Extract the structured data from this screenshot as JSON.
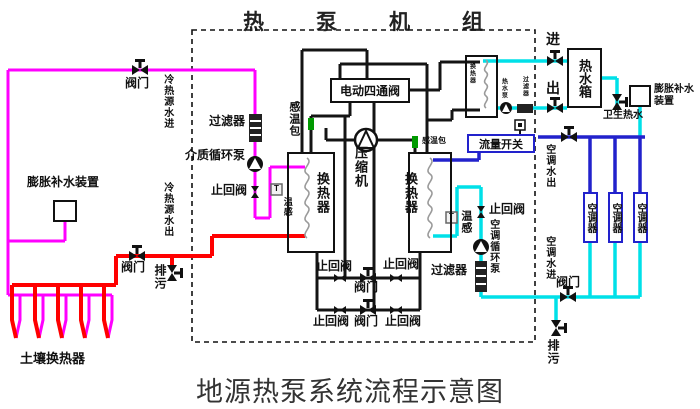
{
  "titles": {
    "top": "热泵机组",
    "bottom": "地源热泵系统流程示意图"
  },
  "colors": {
    "magenta": "#ff00ff",
    "red": "#ff0000",
    "cyan": "#00e0e8",
    "blue": "#2222cc",
    "green": "#009900",
    "pipe_black": "#141414"
  },
  "boxes": {
    "four_way_valve": "电动四通阀",
    "flow_switch": "流量开关",
    "tank": "热水箱",
    "ac_units": [
      "空调器",
      "空调器",
      "空调器"
    ]
  },
  "labels": [
    {
      "name": "valve-label-topleft",
      "text": "阀门",
      "x": 125,
      "y": 77,
      "s": 12
    },
    {
      "name": "source-water-in-label",
      "text": "冷热源水进",
      "x": 161,
      "y": 74,
      "s": 10,
      "v": true
    },
    {
      "name": "source-water-out-label",
      "text": "冷热源水出",
      "x": 161,
      "y": 182,
      "s": 10,
      "v": true
    },
    {
      "name": "filter-label-left",
      "text": "过滤器",
      "x": 209,
      "y": 115,
      "s": 12
    },
    {
      "name": "medium-pump-label",
      "text": "介质循环泵",
      "x": 185,
      "y": 149,
      "s": 12
    },
    {
      "name": "check-valve-label-left",
      "text": "止回阀",
      "x": 211,
      "y": 184,
      "s": 12
    },
    {
      "name": "temp-sensor-glyph-left",
      "text": "T",
      "x": 274,
      "y": 185,
      "s": 8
    },
    {
      "name": "temp-sensor-label-left",
      "text": "温感",
      "x": 282,
      "y": 197,
      "s": 9,
      "v": true
    },
    {
      "name": "bulb-label-left",
      "text": "感温包",
      "x": 287,
      "y": 101,
      "s": 11,
      "v": true
    },
    {
      "name": "bulb-label-right",
      "text": "感温包",
      "x": 422,
      "y": 137,
      "s": 8
    },
    {
      "name": "compressor-label",
      "text": "压缩机",
      "x": 353,
      "y": 146,
      "s": 13,
      "v": true
    },
    {
      "name": "hx-label-left",
      "text": "换热器",
      "x": 315,
      "y": 172,
      "s": 13,
      "v": true
    },
    {
      "name": "hx-label-right",
      "text": "换热器",
      "x": 403,
      "y": 172,
      "s": 13,
      "v": true
    },
    {
      "name": "hx-label-hotwater",
      "text": "换热器",
      "x": 468,
      "y": 63,
      "s": 6,
      "v": true
    },
    {
      "name": "hotwater-pump-label",
      "text": "热水泵",
      "x": 500,
      "y": 78,
      "s": 6,
      "v": true
    },
    {
      "name": "hotwater-filter-label",
      "text": "过滤器",
      "x": 521,
      "y": 76,
      "s": 6,
      "v": true
    },
    {
      "name": "inlet-label",
      "text": "进",
      "x": 546,
      "y": 32,
      "s": 14
    },
    {
      "name": "outlet-label",
      "text": "出",
      "x": 546,
      "y": 81,
      "s": 14
    },
    {
      "name": "sanitary-hotwater-label",
      "text": "卫生热水",
      "x": 603,
      "y": 111,
      "s": 10
    },
    {
      "name": "expansion-label-right",
      "text": "膨胀补水装置",
      "x": 654,
      "y": 84,
      "s": 10,
      "w": 46
    },
    {
      "name": "ac-water-out-label",
      "text": "空调水出",
      "x": 543,
      "y": 144,
      "s": 10,
      "v": true
    },
    {
      "name": "ac-water-in-label",
      "text": "空调水进",
      "x": 543,
      "y": 236,
      "s": 10,
      "v": true
    },
    {
      "name": "valve-label-ac",
      "text": "阀门",
      "x": 556,
      "y": 276,
      "s": 12
    },
    {
      "name": "drain-label-right",
      "text": "排污",
      "x": 546,
      "y": 339,
      "s": 12,
      "v": true
    },
    {
      "name": "check-valve-label-ac",
      "text": "止回阀",
      "x": 489,
      "y": 203,
      "s": 12
    },
    {
      "name": "temp-sensor-label-right",
      "text": "温感",
      "x": 459,
      "y": 210,
      "s": 11,
      "v": true
    },
    {
      "name": "temp-sensor-glyph-right",
      "text": "T",
      "x": 449,
      "y": 213,
      "s": 8
    },
    {
      "name": "ac-pump-label",
      "text": "空调循环泵",
      "x": 487,
      "y": 219,
      "s": 10,
      "v": true
    },
    {
      "name": "filter-label-ac",
      "text": "过滤器",
      "x": 431,
      "y": 264,
      "s": 12
    },
    {
      "name": "check-valve-label-midtop-left",
      "text": "止回阀",
      "x": 316,
      "y": 260,
      "s": 12
    },
    {
      "name": "check-valve-label-midtop-right",
      "text": "止回阀",
      "x": 383,
      "y": 258,
      "s": 12
    },
    {
      "name": "valve-label-mid-top",
      "text": "阀门",
      "x": 354,
      "y": 281,
      "s": 12
    },
    {
      "name": "check-valve-label-midbot-left",
      "text": "止回阀",
      "x": 313,
      "y": 315,
      "s": 12
    },
    {
      "name": "valve-label-mid-bottom",
      "text": "阀门",
      "x": 354,
      "y": 315,
      "s": 12
    },
    {
      "name": "check-valve-label-midbot-right",
      "text": "止回阀",
      "x": 385,
      "y": 315,
      "s": 12
    },
    {
      "name": "expansion-label-left",
      "text": "膨胀补水装置",
      "x": 27,
      "y": 176,
      "s": 12
    },
    {
      "name": "soil-hx-label",
      "text": "土壤换热器",
      "x": 20,
      "y": 352,
      "s": 13
    },
    {
      "name": "valve-label-ground",
      "text": "阀门",
      "x": 121,
      "y": 261,
      "s": 12
    },
    {
      "name": "drain-label-ground",
      "text": "排污",
      "x": 153,
      "y": 264,
      "s": 12,
      "v": true
    }
  ]
}
